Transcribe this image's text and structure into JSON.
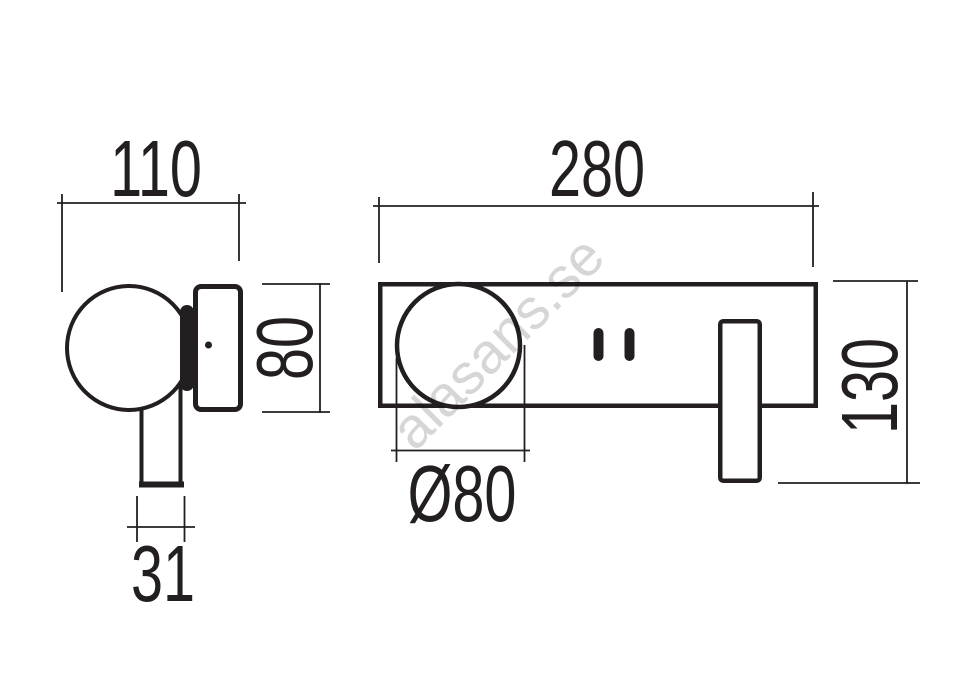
{
  "colors": {
    "background": "#ffffff",
    "line": "#231f20",
    "watermark": "#d6d6d8"
  },
  "watermark": {
    "text": "alasans.se"
  },
  "side_view": {
    "depth_dim": {
      "label": "110"
    },
    "plate_height_dim": {
      "label": "80"
    },
    "arm_width_dim": {
      "label": "31"
    }
  },
  "front_view": {
    "width_dim": {
      "label": "280"
    },
    "height_dim": {
      "label": "130"
    },
    "diameter_dim": {
      "label": "Ø80"
    }
  }
}
